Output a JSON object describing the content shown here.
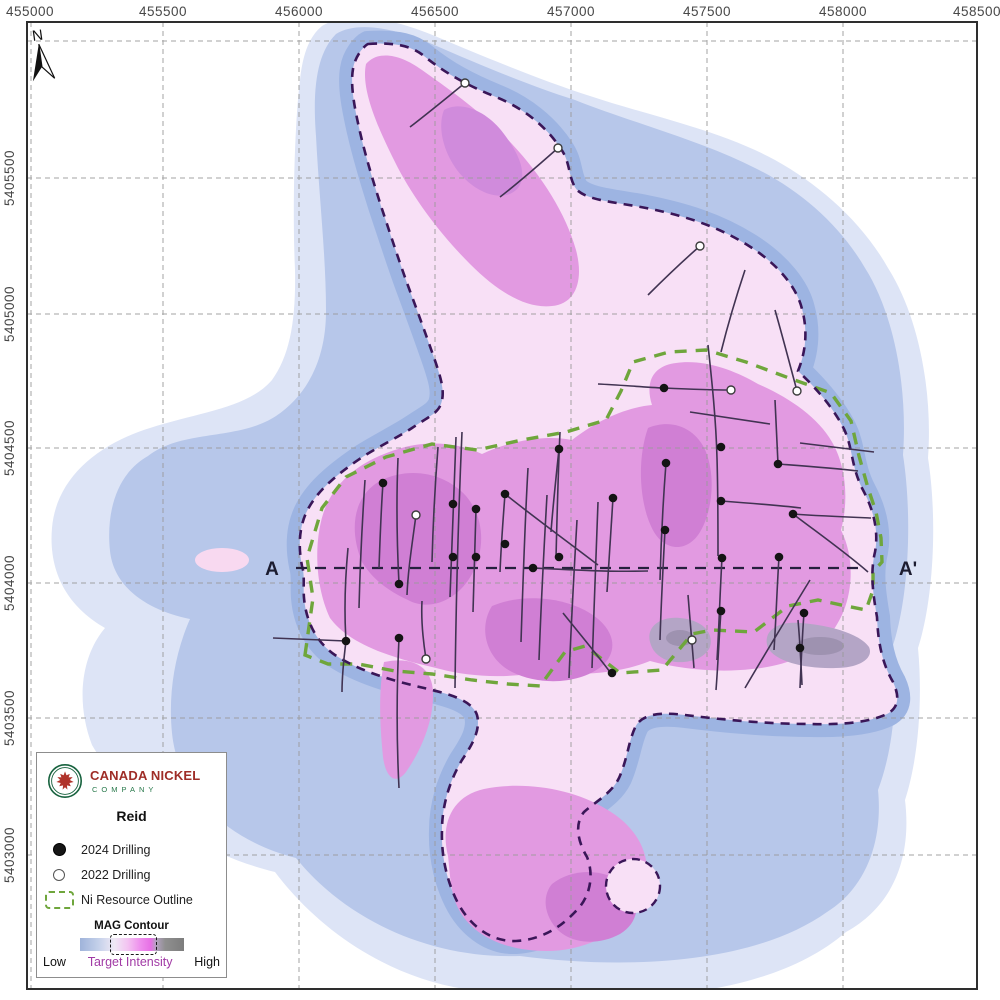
{
  "map": {
    "axis": {
      "top": [
        "455000",
        "455500",
        "456000",
        "456500",
        "457000",
        "457500",
        "458000",
        "458500"
      ],
      "left": [
        "5405500",
        "5405000",
        "5404500",
        "5404000",
        "5403500",
        "5403000"
      ]
    },
    "north": "N",
    "section_a": "A",
    "section_a_prime": "A'",
    "drill_2024": [
      [
        383,
        483
      ],
      [
        453,
        504
      ],
      [
        476,
        509
      ],
      [
        505,
        494
      ],
      [
        559,
        449
      ],
      [
        613,
        498
      ],
      [
        346,
        641
      ],
      [
        399,
        584
      ],
      [
        399,
        638
      ],
      [
        453,
        557
      ],
      [
        476,
        557
      ],
      [
        505,
        544
      ],
      [
        533,
        568
      ],
      [
        559,
        557
      ],
      [
        664,
        388
      ],
      [
        666,
        463
      ],
      [
        721,
        447
      ],
      [
        721,
        501
      ],
      [
        665,
        530
      ],
      [
        778,
        464
      ],
      [
        793,
        514
      ],
      [
        722,
        558
      ],
      [
        779,
        557
      ],
      [
        721,
        611
      ],
      [
        804,
        613
      ],
      [
        800,
        648
      ],
      [
        612,
        673
      ]
    ],
    "drill_2022": [
      [
        465,
        83
      ],
      [
        558,
        148
      ],
      [
        700,
        246
      ],
      [
        416,
        515
      ],
      [
        426,
        659
      ],
      [
        731,
        390
      ],
      [
        797,
        391
      ],
      [
        692,
        640
      ]
    ]
  },
  "legend": {
    "company_line1": "CANADA NICKEL",
    "company_line2": "COMPANY",
    "title": "Reid",
    "items": [
      {
        "label": "2024 Drilling"
      },
      {
        "label": "2022 Drilling"
      },
      {
        "label": "Ni Resource Outline"
      }
    ],
    "mag_title": "MAG Contour",
    "scale_low": "Low",
    "scale_mid": "Target Intensity",
    "scale_high": "High"
  },
  "colors": {
    "mag_low_blue": "#9fb3da",
    "mag_target_magenta": "#e76fe5",
    "mag_high_gray": "#8f8f8f",
    "resource_outline_green": "#6fa63c",
    "target_outline_purple": "#3a1658"
  }
}
